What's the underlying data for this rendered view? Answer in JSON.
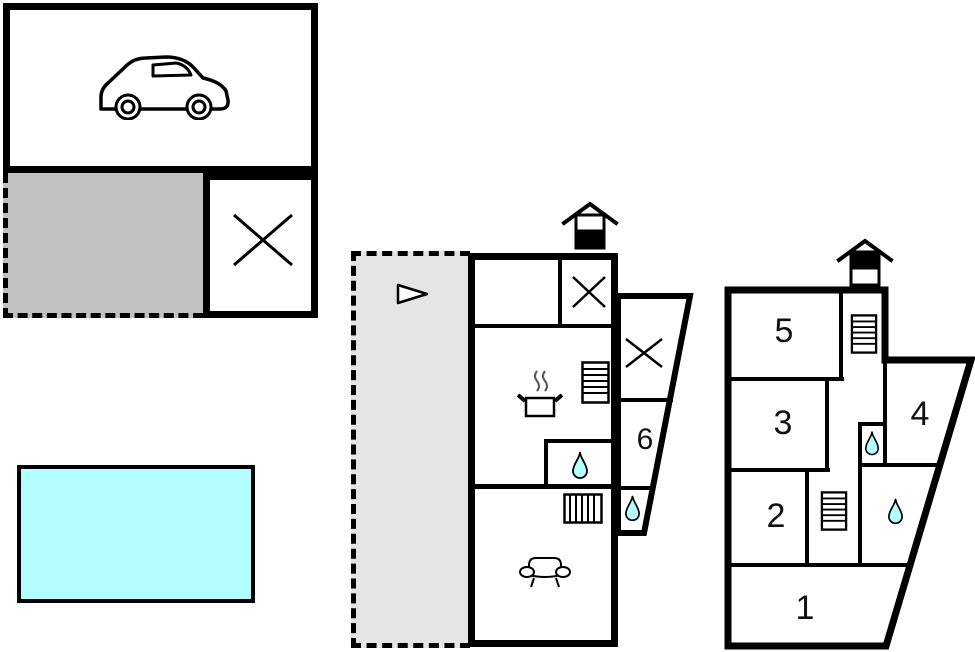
{
  "diagram": {
    "type": "floor-plan",
    "colors": {
      "wall": "#000000",
      "water": "#b3feff",
      "terrace_covered": "#c1c1c1",
      "terrace_open": "#e4e4e4"
    },
    "outdoor": {
      "garage_icon": "car-icon",
      "storage_icon": "x-mark-icon",
      "pool_icon": "swimming-pool"
    },
    "ground_floor": {
      "floor_icon": "house-ground-floor-icon",
      "entrance_arrow_icon": "arrow-right-icon",
      "kitchen_icon": "cooking-pot-icon",
      "stairs_icon": "stairs-icon",
      "radiator_icon": "radiator-icon",
      "sofa_icon": "sofa-icon",
      "bath_icon": "water-drop-icon",
      "room6_label": "6"
    },
    "upper_floor": {
      "floor_icon": "house-upper-floor-icon",
      "stairs_icon": "stairs-icon",
      "bath_icon": "water-drop-icon",
      "room1_label": "1",
      "room2_label": "2",
      "room3_label": "3",
      "room4_label": "4",
      "room5_label": "5"
    }
  }
}
